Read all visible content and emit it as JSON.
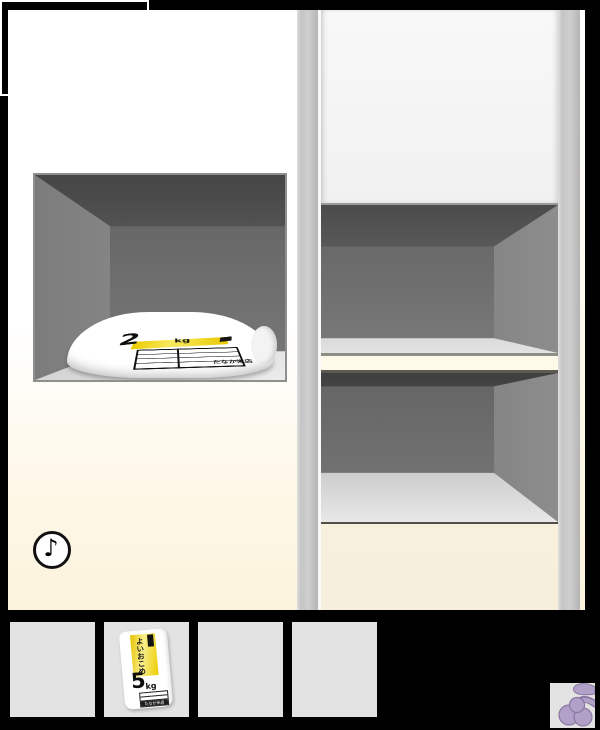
{
  "colors": {
    "accent_label_yellow": "#f2d200",
    "grape_purple": "#b1a0c7",
    "grape_outline": "#8a77a3",
    "slot_gray": "#e3e3e3",
    "cabinet_cream": "#f6efdb",
    "interior_gray": "#6e6e6e",
    "frame_black": "#000000"
  },
  "scene": {
    "music_button": {
      "symbol": "♪"
    },
    "niche_bag": {
      "weight": "2",
      "unit": "kg",
      "shop_name": "たなか米店"
    }
  },
  "inventory": {
    "slots": [
      {
        "index": 1,
        "state": "empty"
      },
      {
        "index": 2,
        "state": "filled",
        "item": {
          "name": "rice-bag-5kg",
          "brand_vertical": "よいおこめ",
          "weight": "5",
          "unit": "kg",
          "shop_name": "たなか米店"
        }
      },
      {
        "index": 3,
        "state": "empty"
      },
      {
        "index": 4,
        "state": "empty"
      },
      {
        "index": 5,
        "state": "active-black",
        "item": {
          "name": "grapes"
        }
      }
    ]
  }
}
